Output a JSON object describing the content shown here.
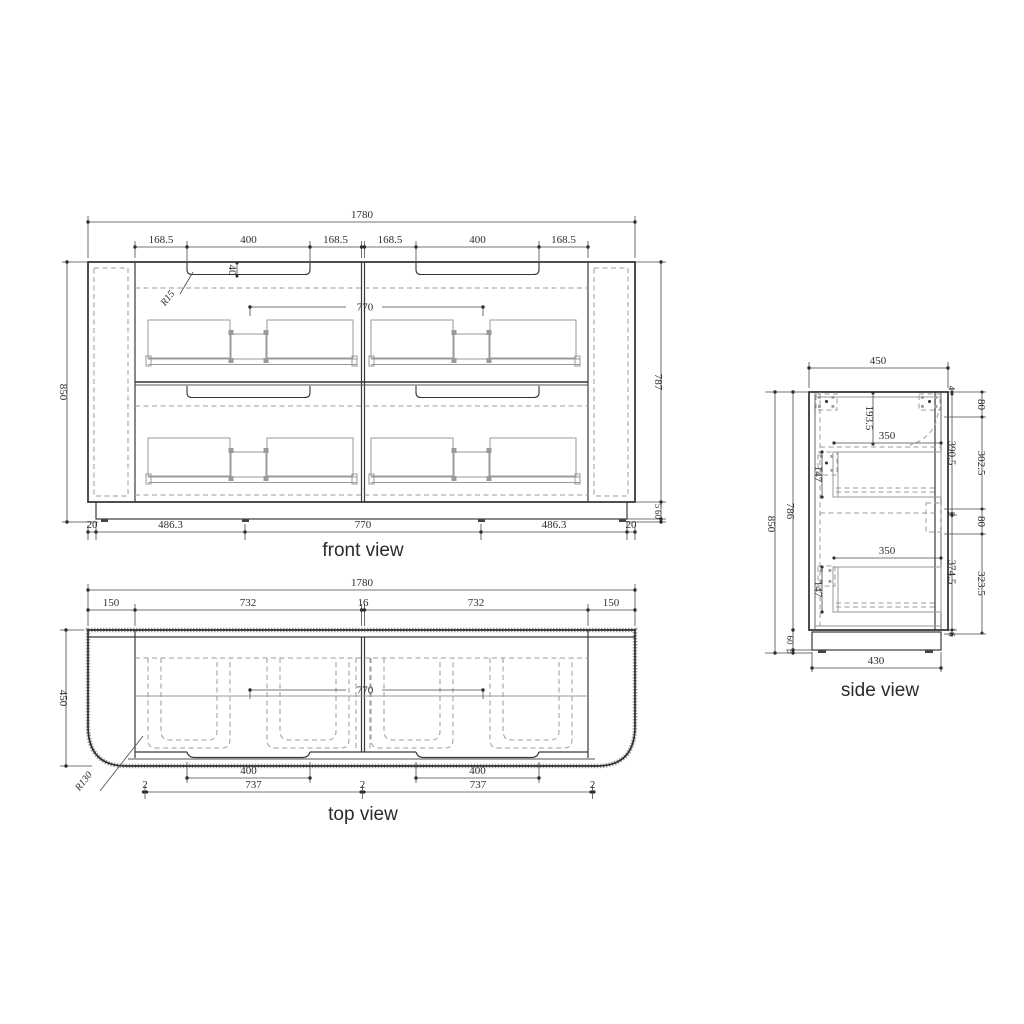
{
  "front_view": {
    "caption": "front view",
    "total_width": "1780",
    "seg_dims": [
      "168.5",
      "400",
      "168.5",
      "168.5",
      "400",
      "168.5"
    ],
    "handle_depth": "40",
    "handle_radius": "R15",
    "handle_spacing": "770",
    "bottom_dims": [
      "20",
      "486.3",
      "770",
      "486.3",
      "20"
    ],
    "total_height": "850",
    "body_height": "787",
    "plinth_dims": [
      "5",
      "60"
    ]
  },
  "top_view": {
    "caption": "top view",
    "total_width": "1780",
    "seg_dims": [
      "150",
      "732",
      "16",
      "732",
      "150"
    ],
    "depth": "450",
    "handle_spacing": "770",
    "handle_widths": [
      "400",
      "400"
    ],
    "bottom_dims": [
      "2",
      "737",
      "2",
      "737",
      "2"
    ],
    "corner_radius": "R130"
  },
  "side_view": {
    "caption": "side view",
    "depth": "450",
    "total_height": "850",
    "body_height": "786",
    "top_clearance": "193.5",
    "drawer_widths": [
      "350",
      "350"
    ],
    "drawer_heights": [
      "147",
      "147"
    ],
    "inner_dims": [
      "4",
      "390.5",
      "2",
      "374.5",
      "16"
    ],
    "outer_dims": [
      "80",
      "302.5",
      "80",
      "323.5"
    ],
    "plinth_dims": [
      "60",
      "5"
    ],
    "bottom_width": "430"
  }
}
